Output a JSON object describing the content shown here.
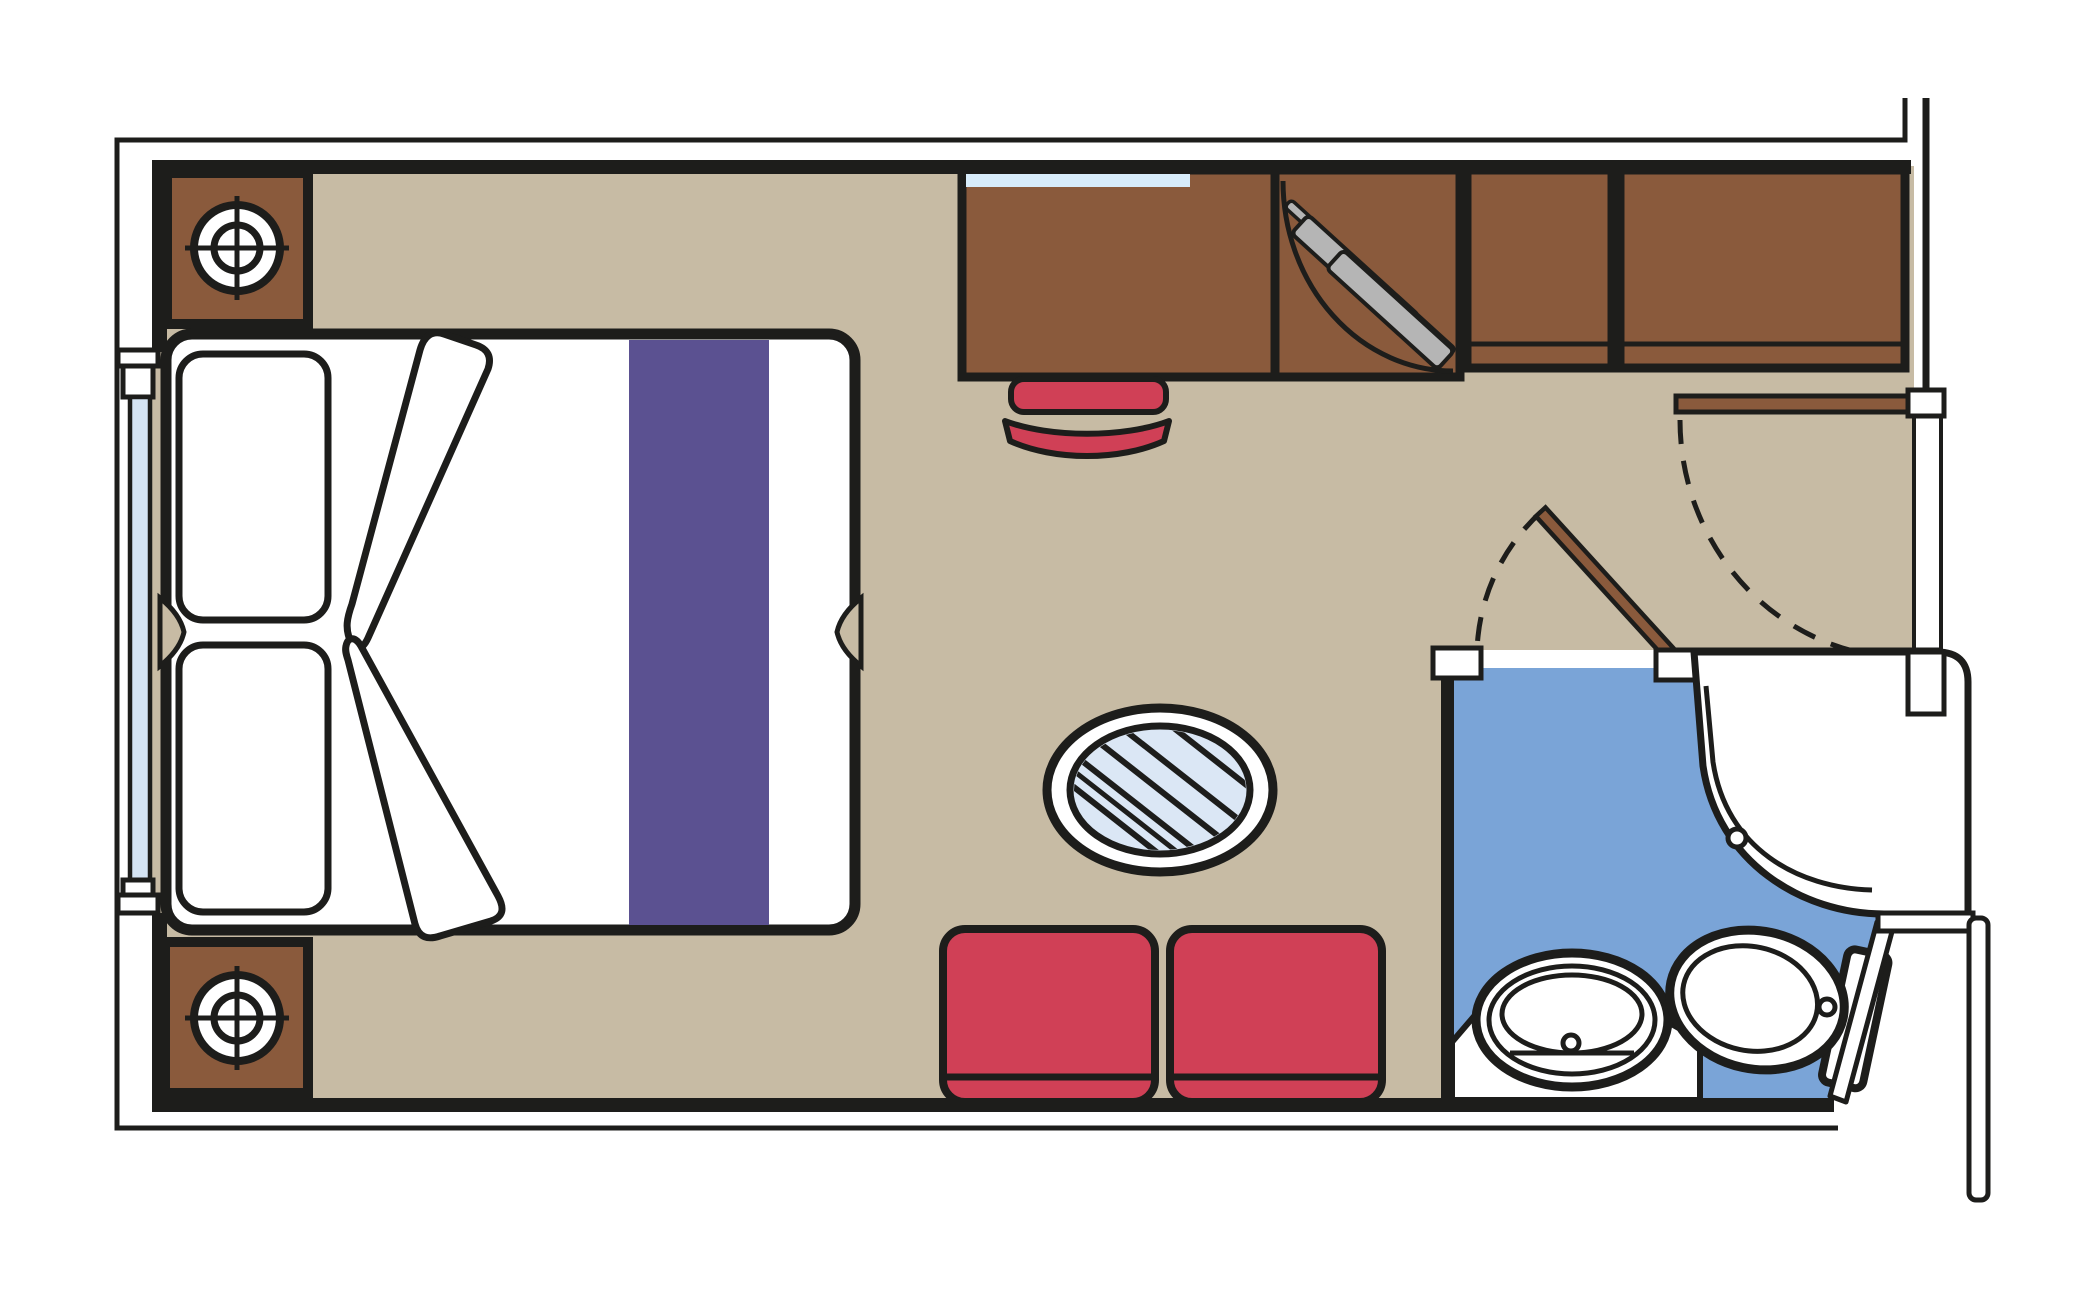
{
  "meta": {
    "title": "Cruise-ship cabin floor plan, top view",
    "diagram_type": "architectural floor plan"
  },
  "colors": {
    "outline": "#1d1d1b",
    "white": "#ffffff",
    "floor_tan": "#c7bba4",
    "bathroom_blue": "#7aa4d7",
    "wood_brown": "#8a5a3c",
    "upholstery_red": "#d04056",
    "runner_purple": "#5b5191",
    "glass_blue": "#d5e4f4",
    "table_glass": "#dbe7f5",
    "shelf_blue": "#d8ecfa",
    "hanger_gray": "#b5b5b5"
  },
  "furniture": {
    "cabin_floor": "Cabin floor",
    "bathroom_floor": "Bathroom floor",
    "bed": "Double bed",
    "pillow_top": "Pillow (top)",
    "pillow_bottom": "Pillow (bottom)",
    "runner": "Bed runner",
    "duvet_fold_top": "Duvet fold (top)",
    "duvet_fold_bottom": "Duvet fold (bottom)",
    "nightstand_top": "Nightstand with lamp (top)",
    "nightstand_bottom": "Nightstand with lamp (bottom)",
    "window": "Panoramic window",
    "desk": "Desk / dresser",
    "desk_shelf": "Glass shelf",
    "desk_chair": "Desk chair",
    "wardrobe": "Wardrobe with hangers",
    "cabinet_a": "Closet unit A",
    "cabinet_b": "Closet unit B",
    "coffee_table": "Round glass table",
    "seat_left": "Sofa seat (left)",
    "seat_right": "Sofa seat (right)",
    "entrance_door": "Cabin entrance door",
    "bathroom_door": "Bathroom door",
    "shower": "Shower enclosure",
    "vanity": "Vanity counter",
    "washbasin": "Washbasin",
    "toilet": "Toilet",
    "walls": "Walls"
  }
}
